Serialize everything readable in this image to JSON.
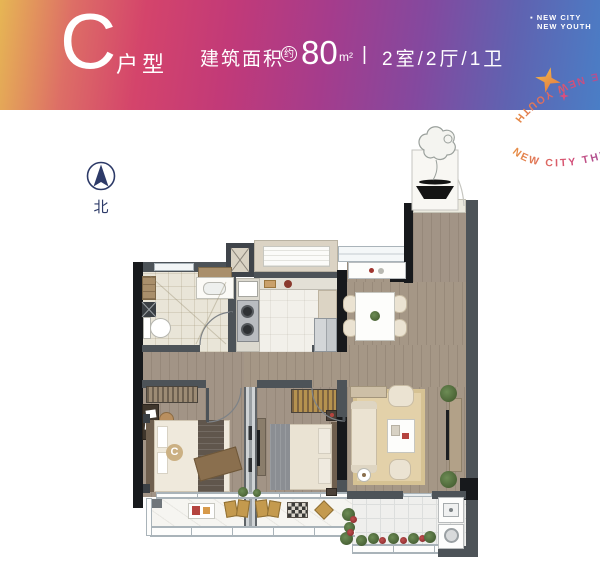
{
  "header": {
    "unit_letter": "C",
    "unit_type_label": "户型",
    "area_label": "建筑面积",
    "area_approx_badge": "约",
    "area_value": "80",
    "area_unit": "m²",
    "separator": "|",
    "layout_text": "2室/2厅/1卫",
    "tagline_bullet": "▪",
    "tagline_line1": "NEW CITY",
    "tagline_line2": "NEW YOUTH"
  },
  "ring_logo": {
    "text": "NEW CITY THE NEW YOUTH NEW CITY THE NEW YOUTH"
  },
  "compass": {
    "label": "北"
  },
  "plan": {
    "bed_monogram": "C"
  },
  "colors": {
    "gradient_start": "#e6b654",
    "gradient_mid": "#c23a78",
    "gradient_end": "#4a7ec6",
    "wall": "#4d5358",
    "wall_dark": "#17191c",
    "wood": "#a29486",
    "accent_gold": "#c49a4e",
    "navy": "#2d3a68"
  }
}
